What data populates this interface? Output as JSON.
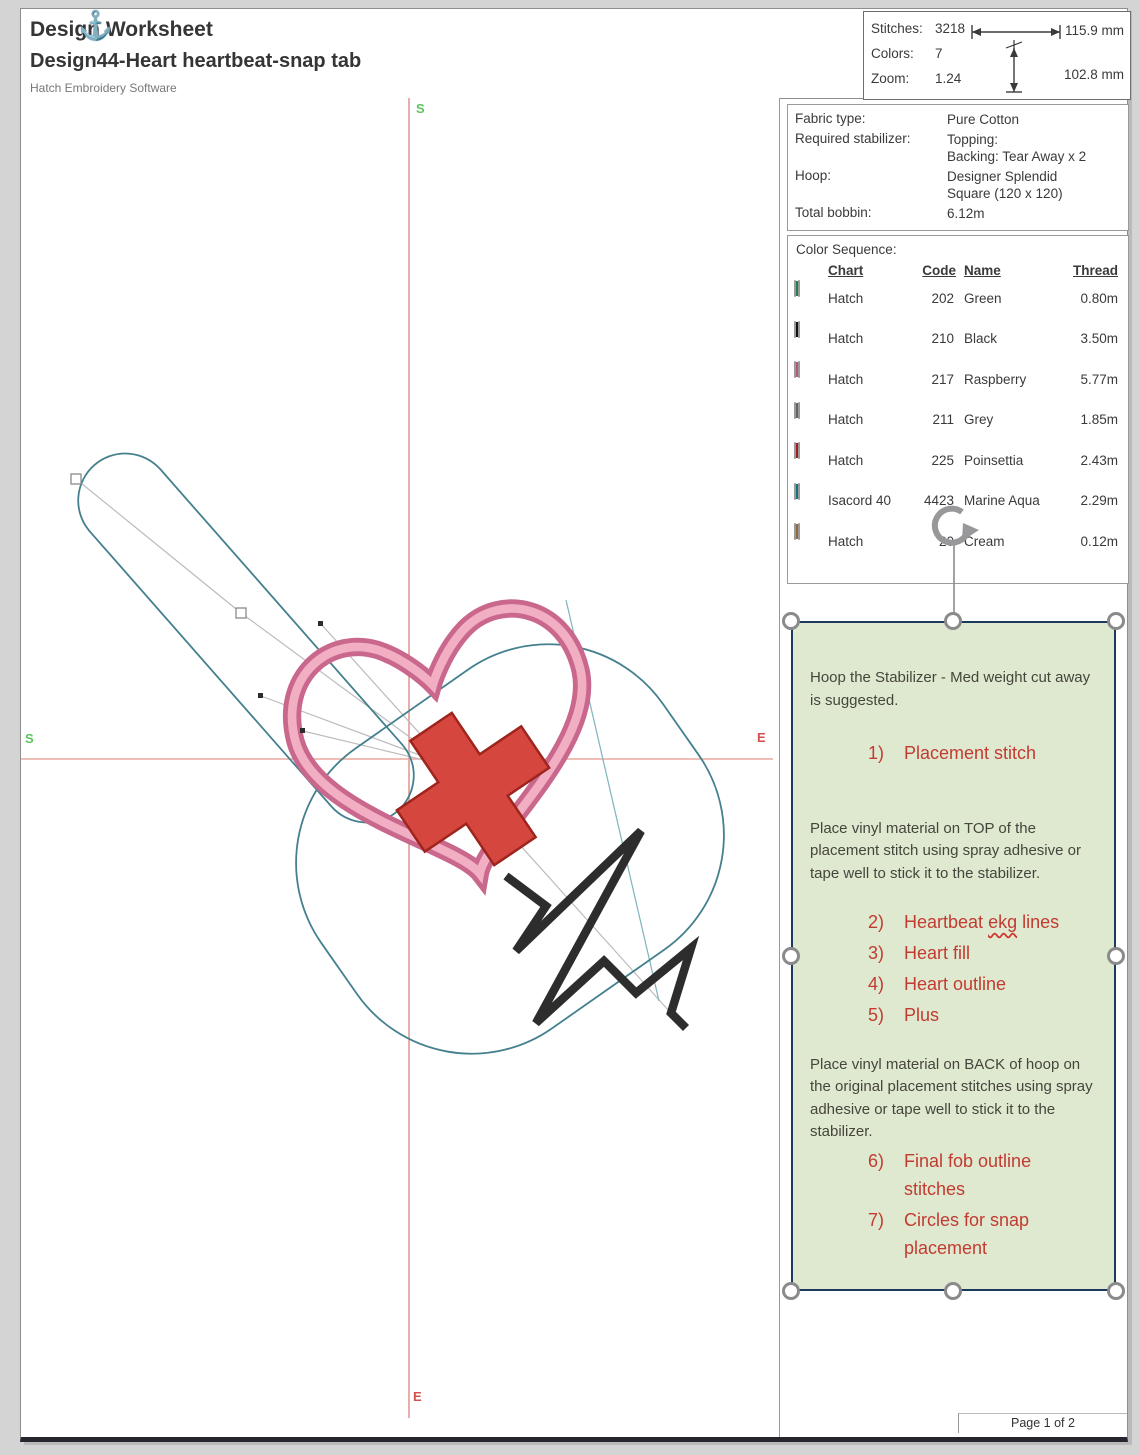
{
  "header": {
    "title": "Design Worksheet",
    "subtitle": "Design44-Heart heartbeat-snap tab",
    "software": "Hatch Embroidery Software",
    "anchor_icon": "⚓"
  },
  "stats": {
    "stitches_label": "Stitches:",
    "stitches": "3218",
    "colors_label": "Colors:",
    "colors": "7",
    "zoom_label": "Zoom:",
    "zoom": "1.24",
    "width_mm": "115.9 mm",
    "height_mm": "102.8 mm"
  },
  "info": {
    "rows": [
      {
        "label": "Fabric type:",
        "value_lines": [
          "Pure Cotton"
        ]
      },
      {
        "label": "Required stabilizer:",
        "value_lines": [
          "Topping:",
          "Backing: Tear Away x 2"
        ]
      },
      {
        "label": "Hoop:",
        "value_lines": [
          "Designer Splendid",
          "Square (120 x 120)"
        ]
      },
      {
        "label": "Total bobbin:",
        "value_lines": [
          "6.12m"
        ]
      }
    ]
  },
  "color_sequence": {
    "title": "Color Sequence:",
    "headers": {
      "chart": "Chart",
      "code": "Code",
      "name": "Name",
      "thread": "Thread"
    },
    "rows": [
      {
        "chart": "Hatch",
        "code": "202",
        "name": "Green",
        "thread": "0.80m",
        "color": "#2f9e5d"
      },
      {
        "chart": "Hatch",
        "code": "210",
        "name": "Black",
        "thread": "3.50m",
        "color": "#151515"
      },
      {
        "chart": "Hatch",
        "code": "217",
        "name": "Raspberry",
        "thread": "5.77m",
        "color": "#e2718f"
      },
      {
        "chart": "Hatch",
        "code": "211",
        "name": "Grey",
        "thread": "1.85m",
        "color": "#7f7f7f"
      },
      {
        "chart": "Hatch",
        "code": "225",
        "name": "Poinsettia",
        "thread": "2.43m",
        "color": "#cf2127"
      },
      {
        "chart": "Isacord 40",
        "code": "4423",
        "name": "Marine Aqua",
        "thread": "2.29m",
        "color": "#16939f"
      },
      {
        "chart": "Hatch",
        "code": "20",
        "name": "Cream",
        "thread": "0.12m",
        "color": "#b3834e"
      }
    ]
  },
  "canvas": {
    "labels": {
      "top": "S",
      "left": "S",
      "right": "E",
      "bottom": "E"
    }
  },
  "instructions": {
    "blocks": [
      {
        "type": "para",
        "text": "Hoop the Stabilizer - Med weight cut away is suggested."
      },
      {
        "type": "item",
        "num": "1)",
        "text": "Placement stitch",
        "cls": "solo"
      },
      {
        "type": "para",
        "text": "Place vinyl material on TOP of the placement stitch using spray adhesive or tape well to stick it to the stabilizer."
      },
      {
        "type": "item",
        "num": "2)",
        "pre": "Heartbeat ",
        "squiggle": "ekg",
        "post": " lines"
      },
      {
        "type": "item",
        "num": "3)",
        "text": "Heart fill"
      },
      {
        "type": "item",
        "num": "4)",
        "text": "Heart outline"
      },
      {
        "type": "item",
        "num": "5)",
        "text": "Plus"
      },
      {
        "type": "para",
        "text": "Place vinyl material on BACK of hoop on the original placement stitches using spray adhesive or tape well to stick it to the stabilizer.",
        "cls": "tight"
      },
      {
        "type": "item",
        "num": "6)",
        "text": "Final fob outline stitches"
      },
      {
        "type": "item",
        "num": "7)",
        "text": "Circles for snap placement"
      }
    ]
  },
  "footer": {
    "page": "Page 1 of 2"
  },
  "palette": {
    "crosshair": "#e29b92",
    "start_label": "#5cc45c",
    "end_label": "#d4524e",
    "fob_outline": "#44808e",
    "heart_dark": "#c9688c",
    "heart_light": "#f2aec3",
    "cross_red": "#d5473e",
    "ekg_black": "#2d2d2d",
    "connector_grey": "#bcbcbc",
    "instruction_bg": "#dfe9d0",
    "instruction_border": "#1c3a5e",
    "instruction_red_text": "#c23b31"
  }
}
